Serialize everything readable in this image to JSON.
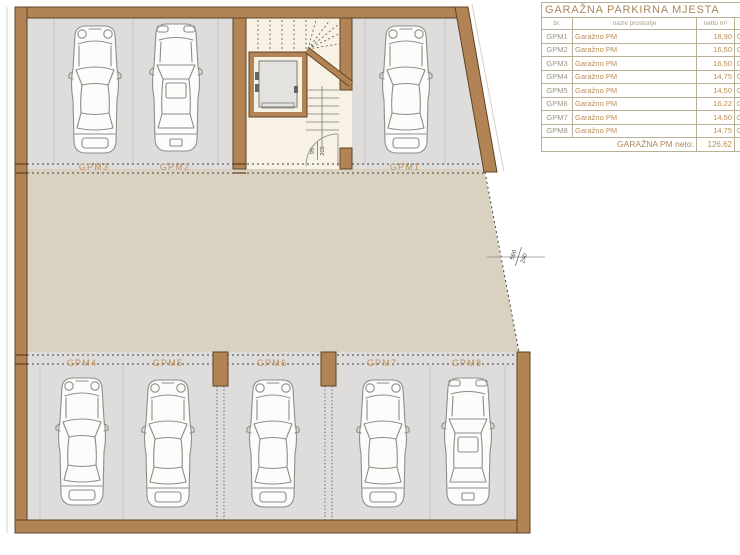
{
  "colors": {
    "wall": "#b28455",
    "wall_edge": "#5f4426",
    "parking_bg": "#dedddb",
    "drive_bg": "#d9d2c0",
    "stair_bg": "#f7f2e3",
    "accent_text": "#c2905c"
  },
  "floor_plan": {
    "space_labels": [
      "GPM3",
      "GPM2",
      "GPM1",
      "GPM4",
      "GPM5",
      "GPM6",
      "GPM7",
      "GPM8"
    ],
    "door_dimension": {
      "width": "95",
      "height": "205"
    },
    "opening_dimension": {
      "width": "560",
      "height": "240"
    }
  },
  "table": {
    "title": "GARAŽNA PARKIRNA MJESTA",
    "columns": {
      "id": "br.",
      "name": "naziv prostorije",
      "area": "netto m²",
      "koef": "koef"
    },
    "rows": [
      {
        "id": "GPM1",
        "name": "Garažno PM",
        "area": "18,90",
        "koef": "0,50"
      },
      {
        "id": "GPM2",
        "name": "Garažno PM",
        "area": "16,50",
        "koef": "0,50"
      },
      {
        "id": "GPM3",
        "name": "Garažno PM",
        "area": "16,50",
        "koef": "0,50"
      },
      {
        "id": "GPM4",
        "name": "Garažno PM",
        "area": "14,75",
        "koef": "0,50"
      },
      {
        "id": "GPM5",
        "name": "Garažno PM",
        "area": "14,50",
        "koef": "0,50"
      },
      {
        "id": "GPM6",
        "name": "Garažno PM",
        "area": "16,22",
        "koef": "0,50"
      },
      {
        "id": "GPM7",
        "name": "Garažno PM",
        "area": "14,50",
        "koef": "0,50"
      },
      {
        "id": "GPM8",
        "name": "Garažno PM",
        "area": "14,75",
        "koef": "0,50"
      }
    ],
    "footer": {
      "label": "GARAŽNA PM neto:",
      "value": "126.62"
    }
  }
}
